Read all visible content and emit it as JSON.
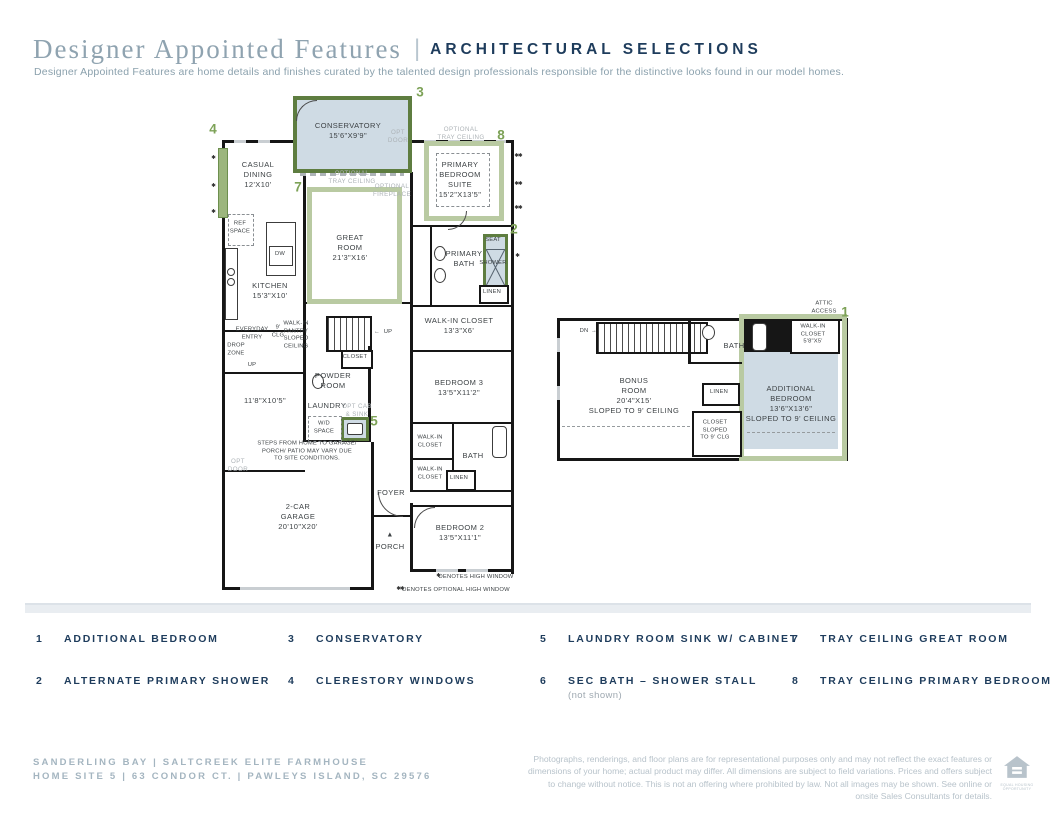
{
  "header": {
    "title_serif": "Designer Appointed Features",
    "title_divider": "|",
    "title_sans": "ARCHITECTURAL SELECTIONS",
    "subtitle": "Designer Appointed Features are home details and finishes curated by the talented design professionals responsible for the distinctive looks found in our model homes."
  },
  "colors": {
    "navy": "#1e3c5c",
    "title_gray_blue": "#8fa3b0",
    "callout_green": "#7da257",
    "dark_green_border": "#5e7d40",
    "light_green_tray": "#b9caa2",
    "blue_room_fill": "#cfdbe4",
    "wall_black": "#161616"
  },
  "icons": {
    "arrow_left": "←",
    "arrow_right": "→",
    "triangle": "▲"
  },
  "callouts": {
    "c1": "1",
    "c2": "2",
    "c3": "3",
    "c4": "4",
    "c5": "5",
    "c7": "7",
    "c8": "8"
  },
  "plan1": {
    "conservatory": "CONSERVATORY\n15'6\"X9'9\"",
    "opt_door_top": "OPT\nDOOR",
    "casual_dining": "CASUAL\nDINING\n12'X10'",
    "tray_great": "OPTIONAL\nTRAY CEILING",
    "tray_primary": "OPTIONAL\nTRAY CEILING",
    "opt_fireplace": "OPTIONAL\nFIREPLACE",
    "primary_suite": "PRIMARY\nBEDROOM\nSUITE\n15'2\"X13'5\"",
    "great_room": "GREAT\nROOM\n21'3\"X16'",
    "kitchen": "KITCHEN\n15'3\"X10'",
    "ref_space": "REF\nSPACE",
    "dw": "DW",
    "primary_bath": "PRIMARY\nBATH",
    "seat": "SEAT",
    "shower": "SHOWER",
    "linen_primary": "LINEN",
    "walk_in_primary": "WALK-IN CLOSET\n13'3\"X6'",
    "everyday_entry": "EVERYDAY\nENTRY",
    "clg": "9'\nCLG",
    "pantry": "WALK-IN\nPANTRY\nSLOPED\nCEILING",
    "drop_zone": "DROP\nZONE",
    "up_left": "UP",
    "up_stairs": "UP",
    "closet_hall": "CLOSET",
    "powder": "POWDER\nROOM",
    "laundry": "LAUNDRY",
    "wd_space": "W/D\nSPACE",
    "opt_cab": "OPT CAB\n& SINK",
    "flex_dims": "11'8\"X10'5\"",
    "steps_note": "STEPS FROM HOME TO GARAGE/\nPORCH/ PATIO MAY VARY DUE\nTO SITE CONDITIONS.",
    "opt_door_left": "OPT\nDOOR",
    "bedroom3": "BEDROOM 3\n13'5\"X11'2\"",
    "wic_a": "WALK-IN\nCLOSET",
    "bath": "BATH",
    "wic_b": "WALK-IN\nCLOSET",
    "linen_hall": "LINEN",
    "foyer": "FOYER",
    "garage": "2-CAR\nGARAGE\n20'10\"X20'",
    "porch": "PORCH",
    "bedroom2": "BEDROOM 2\n13'5\"X11'1\"",
    "marker_single": "✱",
    "marker_double": "✱✱",
    "note_high": "DENOTES HIGH WINDOW",
    "note_opt_high": "DENOTES OPTIONAL HIGH WINDOW"
  },
  "plan2": {
    "dn": "DN",
    "bath": "BATH",
    "wic": "WALK-IN\nCLOSET\n5'8\"X5'",
    "attic": "ATTIC\nACCESS",
    "bonus": "BONUS\nROOM\n20'4\"X15'\nSLOPED TO 9' CEILING",
    "linen": "LINEN",
    "closet_sloped": "CLOSET\nSLOPED\nTO 9' CLG",
    "additional": "ADDITIONAL\nBEDROOM\n13'6\"X13'6\"\nSLOPED TO 9' CEILING"
  },
  "legend": {
    "items": [
      {
        "num": "1",
        "label": "ADDITIONAL BEDROOM"
      },
      {
        "num": "2",
        "label": "ALTERNATE PRIMARY SHOWER"
      },
      {
        "num": "3",
        "label": "CONSERVATORY"
      },
      {
        "num": "4",
        "label": "CLERESTORY WINDOWS"
      },
      {
        "num": "5",
        "label": "LAUNDRY ROOM SINK W/ CABINET"
      },
      {
        "num": "6",
        "label": "SEC BATH – SHOWER STALL",
        "note": "(not shown)"
      },
      {
        "num": "7",
        "label": "TRAY CEILING GREAT ROOM"
      },
      {
        "num": "8",
        "label": "TRAY CEILING PRIMARY BEDROOM"
      }
    ]
  },
  "footer": {
    "line1": "SANDERLING BAY  |  SALTCREEK ELITE FARMHOUSE",
    "line2": "HOME SITE 5  |  63 CONDOR CT.  |  PAWLEYS ISLAND, SC 29576",
    "disclaimer": "Photographs, renderings, and floor plans are for representational purposes only and may not reflect the exact features or dimensions of your home; actual product may differ. All dimensions are subject to field variations. Prices and offers subject to change without notice. This is not an offering where prohibited by law. Not all images may be shown. See online or onsite Sales Consultants for details.",
    "eho": "EQUAL HOUSING\nOPPORTUNITY"
  }
}
